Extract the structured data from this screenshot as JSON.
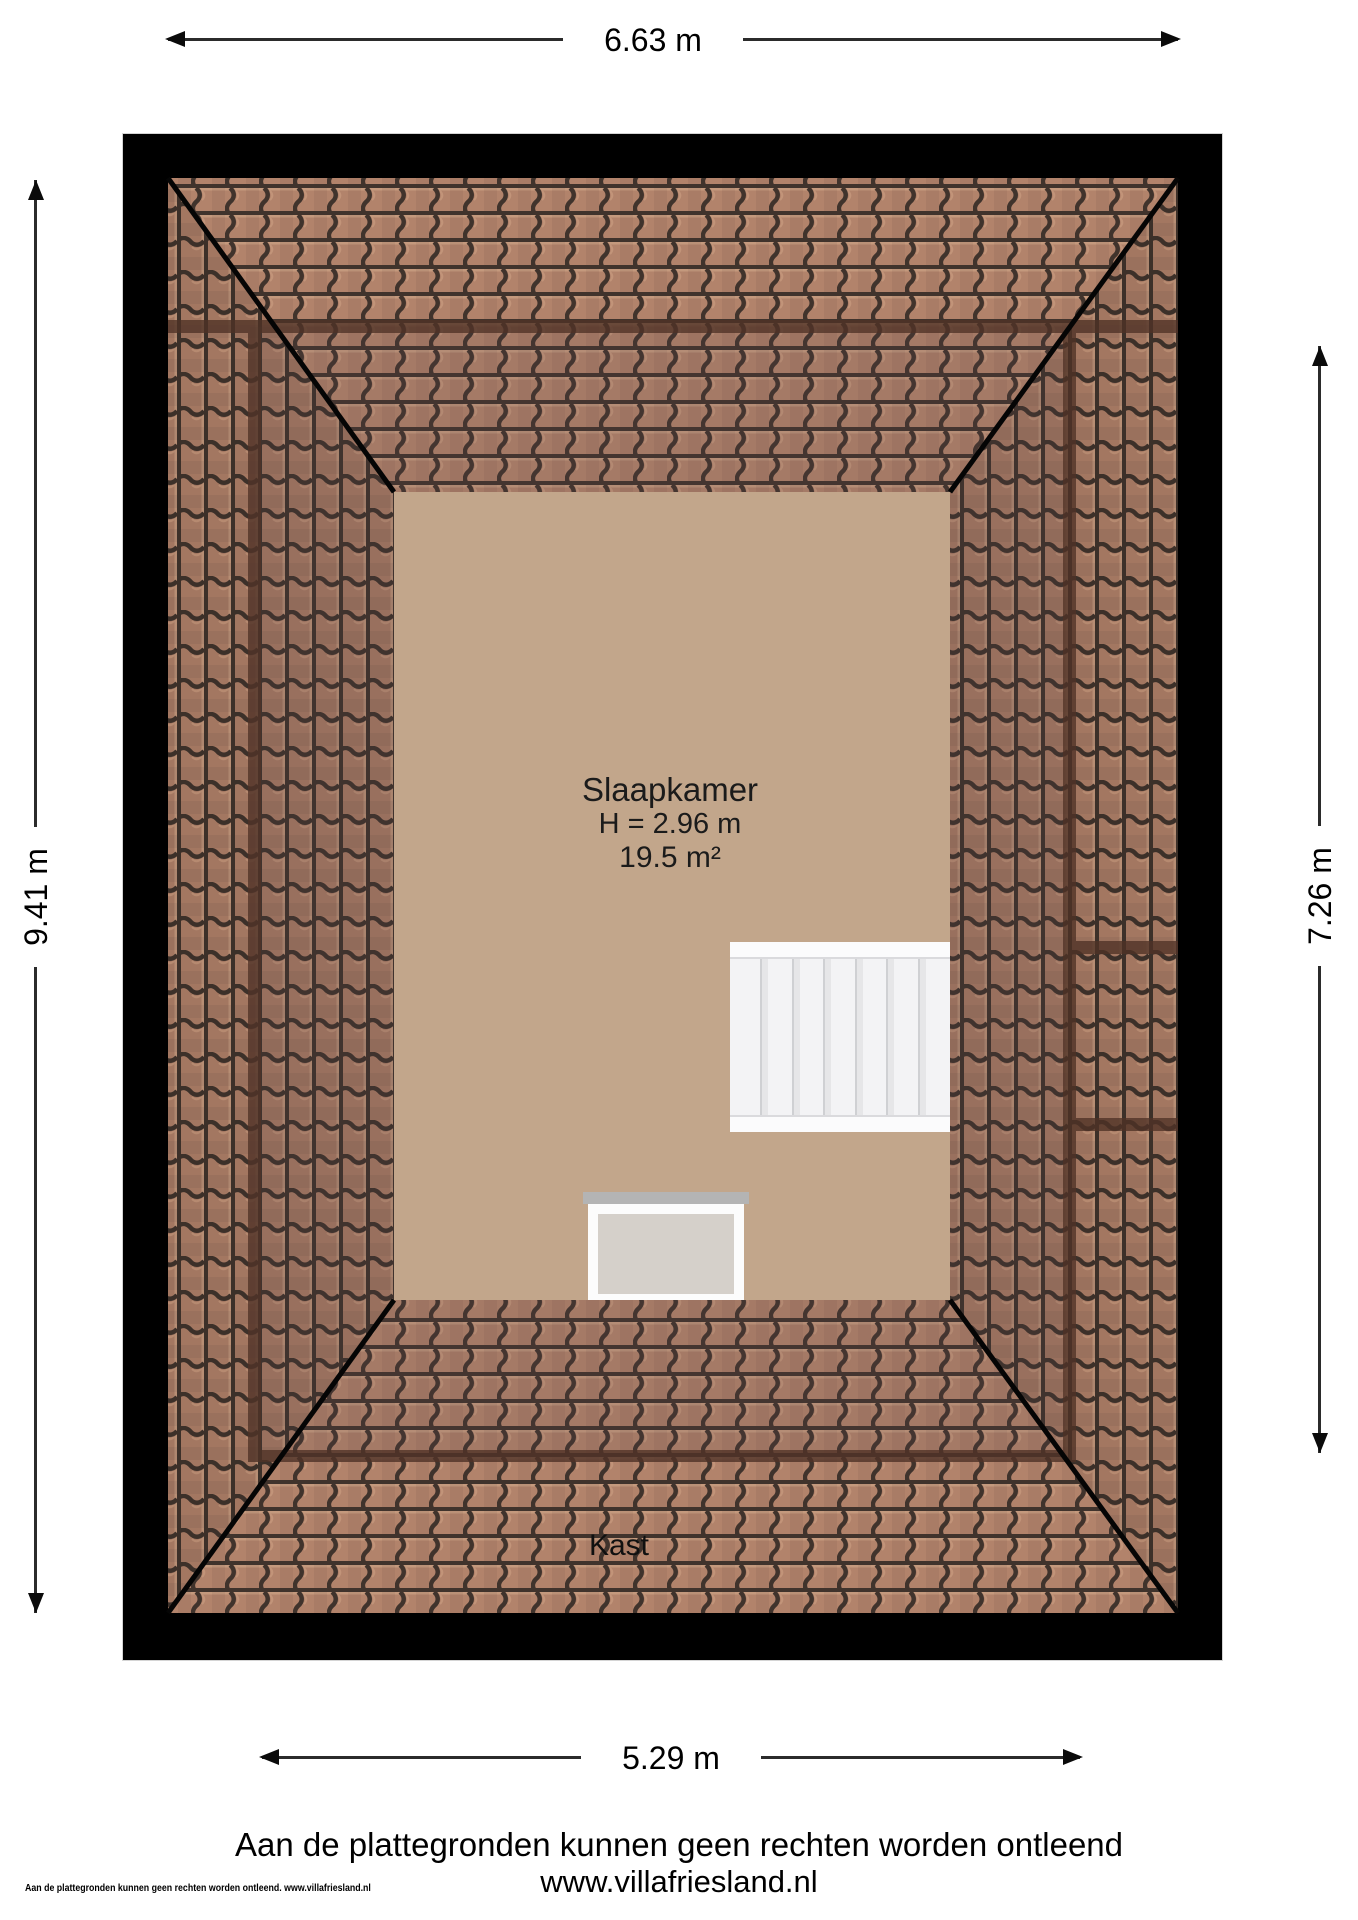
{
  "plan": {
    "type": "floorplan-attic",
    "dimensions": {
      "top": "6.63 m",
      "left": "9.41 m",
      "right": "7.26 m",
      "bottom": "5.29 m"
    },
    "room": {
      "name": "Slaapkamer",
      "ceiling_height": "H = 2.96 m",
      "floor_area": "19.5 m²"
    },
    "labels": {
      "closet": "Kast"
    },
    "features": [
      "hip-roof-tiles",
      "staircase",
      "dormer-window"
    ]
  },
  "footer": {
    "disclaimer": "Aan de plattegronden kunnen geen rechten worden ontleend",
    "website": "www.villafriesland.nl",
    "small_print": "Aan de plattegronden kunnen geen rechten worden ontleend. www.villafriesland.nl"
  },
  "colors": {
    "wall": "#000000",
    "floor": "#c2a68b",
    "tile_body": "#b2836b",
    "tile_gap": "#40332c",
    "wall_seen_through": "#4f3226",
    "stair_tread": "#f3f3f5",
    "dormer_panel": "#d5d0ca",
    "dimension_line": "#2b2b2b"
  }
}
